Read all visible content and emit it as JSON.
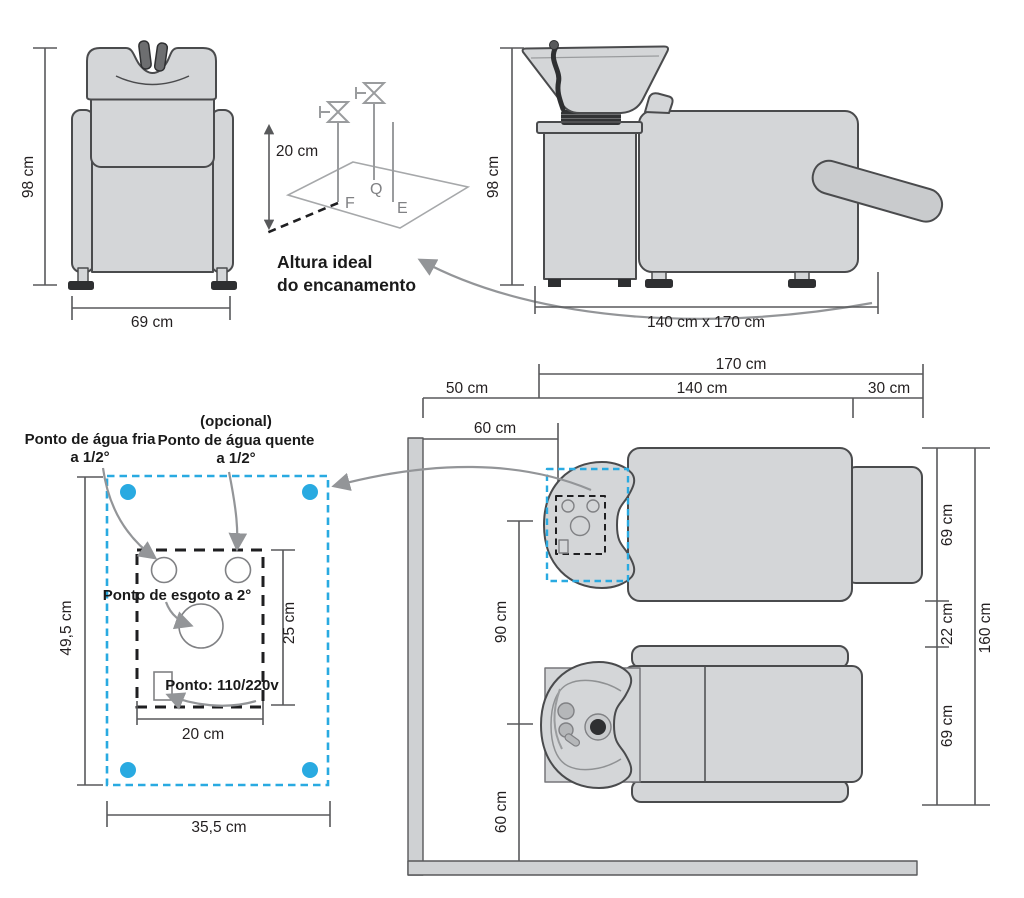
{
  "colors": {
    "accent_blue": "#29aae1",
    "chair_fill": "#d4d6d8",
    "outline": "#4a4b4d",
    "dim_line": "#58595b",
    "arrow_gray": "#939598",
    "dark_accent": "#2e2f31",
    "text": "#231f20"
  },
  "front_view": {
    "dim_height": "98 cm",
    "dim_width": "69 cm"
  },
  "pipe_diagram": {
    "dim_riser": "20 cm",
    "label_f": "F",
    "label_q": "Q",
    "label_e": "E",
    "caption1": "Altura ideal",
    "caption2": "do encanamento"
  },
  "side_view": {
    "dim_height": "98 cm",
    "dim_footprint": "140 cm x 170 cm"
  },
  "floor_plan": {
    "label_cold1": "Ponto de água fria",
    "label_cold2": "a 1/2°",
    "label_opt": "(opcional)",
    "label_hot1": "Ponto de água quente",
    "label_hot2": "a 1/2°",
    "label_drain": "Ponto de esgoto a 2°",
    "label_power": "Ponto: 110/220v",
    "dim_width_inner": "20 cm",
    "dim_height_inner": "25 cm",
    "dim_width_outer": "35,5 cm",
    "dim_height_outer": "49,5 cm"
  },
  "top_view": {
    "dim_total_len": "170 cm",
    "dim_50": "50 cm",
    "dim_140": "140 cm",
    "dim_30": "30 cm",
    "dim_60_top": "60 cm",
    "dim_90": "90 cm",
    "dim_60_bottom": "60 cm",
    "dim_69_a": "69 cm",
    "dim_22": "22 cm",
    "dim_69_b": "69 cm",
    "dim_160": "160 cm"
  }
}
